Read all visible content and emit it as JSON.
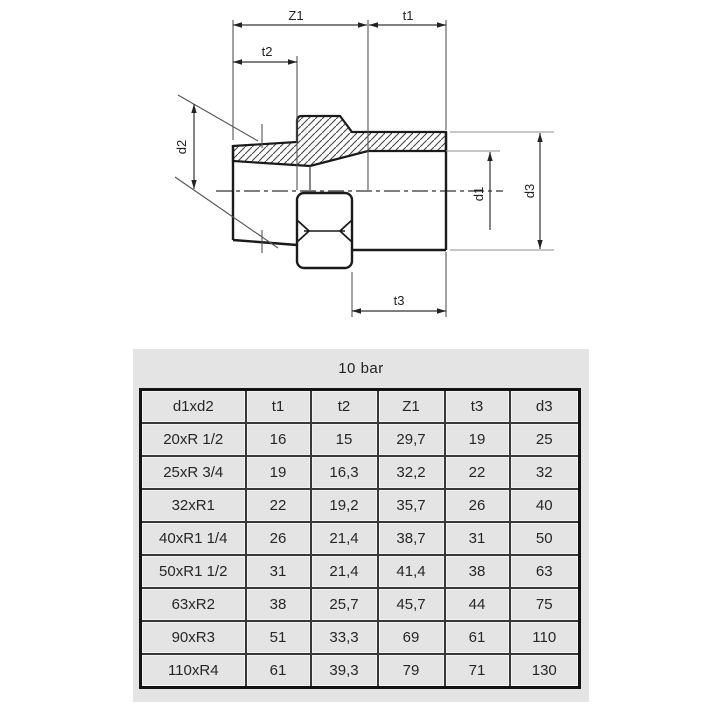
{
  "diagram": {
    "labels": {
      "z1": "Z1",
      "t1": "t1",
      "t2": "t2",
      "t3": "t3",
      "d1": "d1",
      "d2": "d2",
      "d3": "d3"
    }
  },
  "table": {
    "title": "10 bar",
    "columns": [
      "d1xd2",
      "t1",
      "t2",
      "Z1",
      "t3",
      "d3"
    ],
    "rows": [
      [
        "20xR 1/2",
        "16",
        "15",
        "29,7",
        "19",
        "25"
      ],
      [
        "25xR 3/4",
        "19",
        "16,3",
        "32,2",
        "22",
        "32"
      ],
      [
        "32xR1",
        "22",
        "19,2",
        "35,7",
        "26",
        "40"
      ],
      [
        "40xR1 1/4",
        "26",
        "21,4",
        "38,7",
        "31",
        "50"
      ],
      [
        "50xR1 1/2",
        "31",
        "21,4",
        "41,4",
        "38",
        "63"
      ],
      [
        "63xR2",
        "38",
        "25,7",
        "45,7",
        "44",
        "75"
      ],
      [
        "90xR3",
        "51",
        "33,3",
        "69",
        "61",
        "110"
      ],
      [
        "110xR4",
        "61",
        "39,3",
        "79",
        "71",
        "130"
      ]
    ]
  },
  "colors": {
    "panel_background": "#e4e4e4",
    "cell_background": "#e4e4e4",
    "outline": "#1b1b1b",
    "thin_line": "#555555",
    "gray_line": "#8f8f8f",
    "table_border": "#131313",
    "text": "#262626"
  }
}
